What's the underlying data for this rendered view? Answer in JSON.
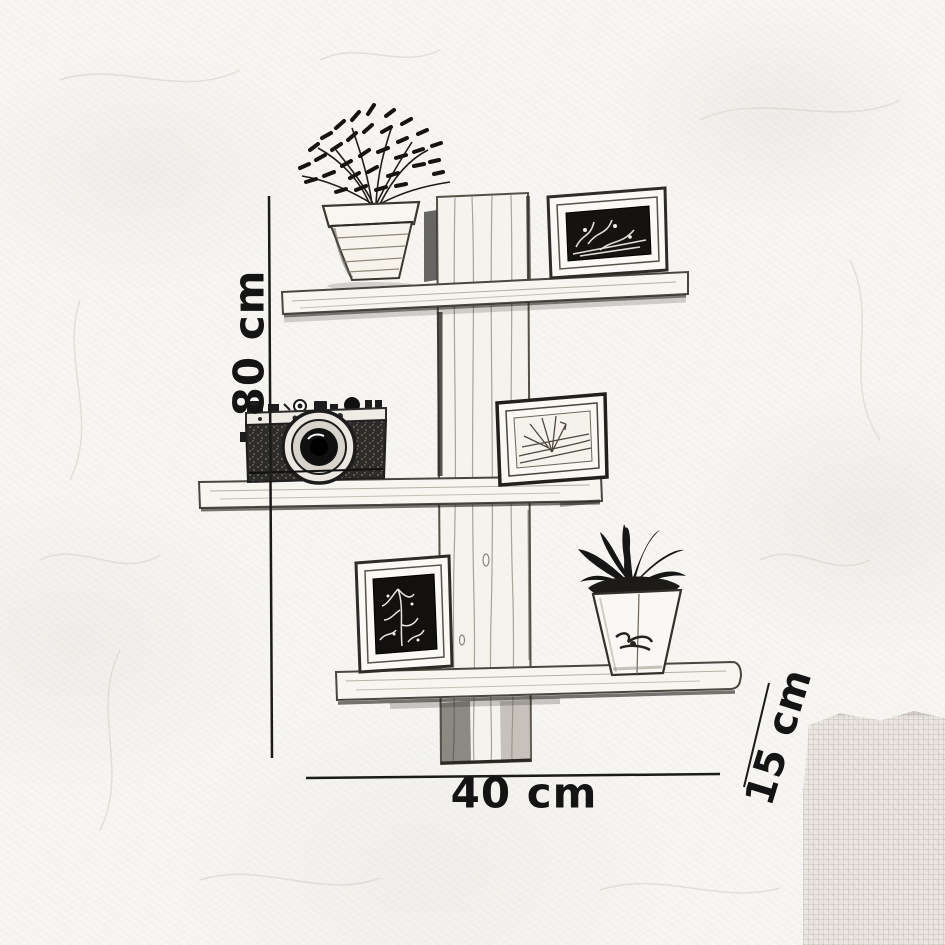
{
  "dimensions": {
    "height_label": "80 cm",
    "width_label": "40 cm",
    "depth_label": "15 cm"
  },
  "scene": {
    "structure": [
      "vertical-post",
      "shelf-board-top",
      "shelf-board-middle",
      "shelf-board-bottom"
    ],
    "items": [
      "potted-plant-bushy",
      "picture-frame-dark-landscape",
      "vintage-camera",
      "picture-frame-light-landscape",
      "picture-frame-dark-portrait",
      "potted-plant-aloe"
    ]
  },
  "colors": {
    "ink": "#1a1a1a",
    "paper": "#f7f6f2",
    "wood_fill": "#f6f4ef",
    "dark_frame_fill": "#151310",
    "corner_patch": "#ebe7e0"
  }
}
